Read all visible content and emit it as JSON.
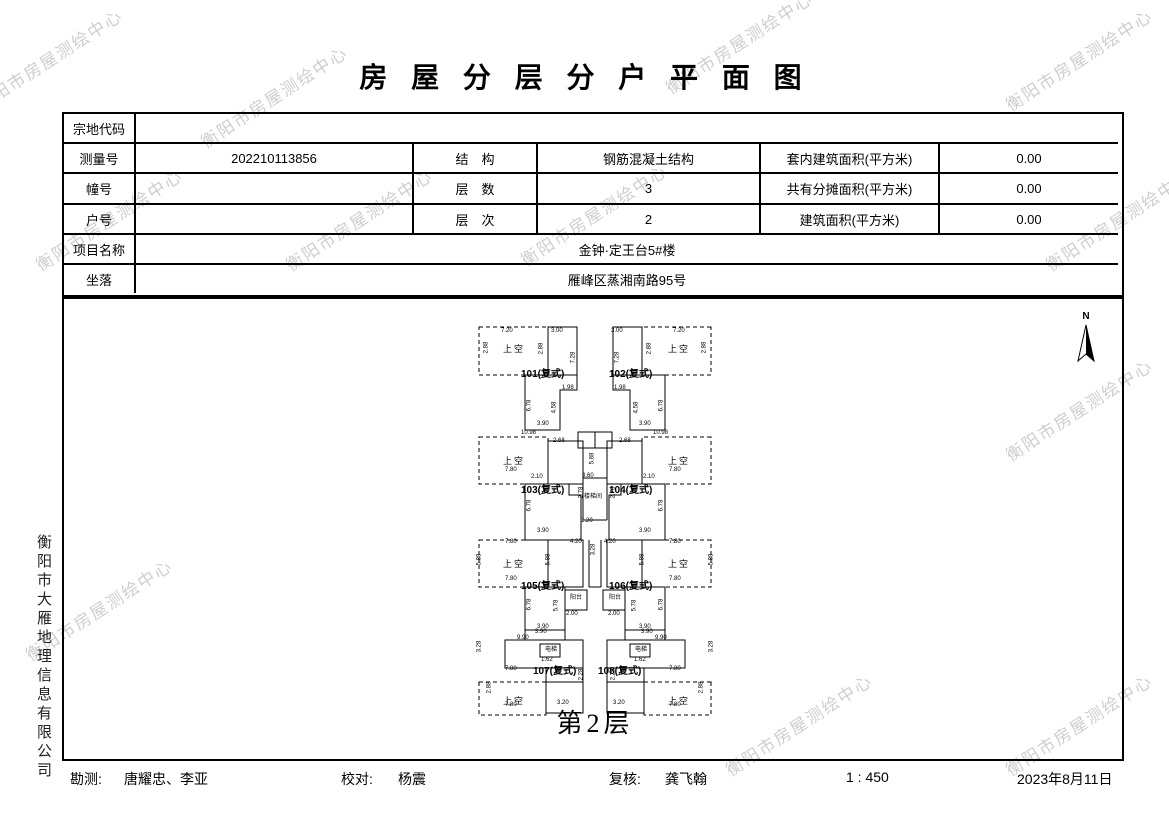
{
  "watermark": {
    "text": "衡阳市房屋测绘中心",
    "color": "#c9c9c9"
  },
  "title": "房 屋 分 层 分 户 平 面 图",
  "table": {
    "parcel_label": "宗地代码",
    "parcel_value": "",
    "survey_label": "测量号",
    "survey_value": "202210113856",
    "structure_label": "结　构",
    "structure_value": "钢筋混凝土结构",
    "inner_area_label": "套内建筑面积(平方米)",
    "inner_area_value": "0.00",
    "building_no_label": "幢号",
    "building_no_value": "",
    "floors_label": "层　数",
    "floors_value": "3",
    "shared_area_label": "共有分摊面积(平方米)",
    "shared_area_value": "0.00",
    "unit_no_label": "户号",
    "unit_no_value": "",
    "level_label": "层　次",
    "level_value": "2",
    "area_label": "建筑面积(平方米)",
    "area_value": "0.00",
    "project_label": "项目名称",
    "project_value": "金钟·定王台5#楼",
    "location_label": "坐落",
    "location_value": "雁峰区蒸湘南路95号"
  },
  "plan": {
    "caption": "第2层",
    "north": "N",
    "units": [
      "101(复式)",
      "102(复式)",
      "103(复式)",
      "104(复式)",
      "105(复式)",
      "106(复式)",
      "107(复式)",
      "108(复式)"
    ],
    "void_label": "上空",
    "balcony_label": "阳台",
    "elevator_label": "电梯",
    "stair_label": "楼梯间",
    "dims": {
      "d120": "1.20",
      "d162": "1.62",
      "d198": "1.98",
      "d200": "2.00",
      "d210": "2.10",
      "d228": "2.28",
      "d268": "2.68",
      "d278": "2.78",
      "d288": "2.88",
      "d300": "3.00",
      "d320": "3.20",
      "d328": "3.28",
      "d360": "3.60",
      "d390": "3.90",
      "d420": "4.20",
      "d458": "4.58",
      "d578": "5.78",
      "d588": "5.88",
      "d678": "6.78",
      "d720": "7.20",
      "d728": "7.28",
      "d780": "7.80",
      "d990": "9.90",
      "d1098": "10.98"
    }
  },
  "company_side": "衡阳市大雁地理信息有限公司",
  "footer": {
    "survey_label": "勘测:",
    "survey_value": "唐耀忠、李亚",
    "check_label": "校对:",
    "check_value": "杨震",
    "review_label": "复核:",
    "review_value": "龚飞翰",
    "scale": "1 : 450",
    "date": "2023年8月11日"
  }
}
